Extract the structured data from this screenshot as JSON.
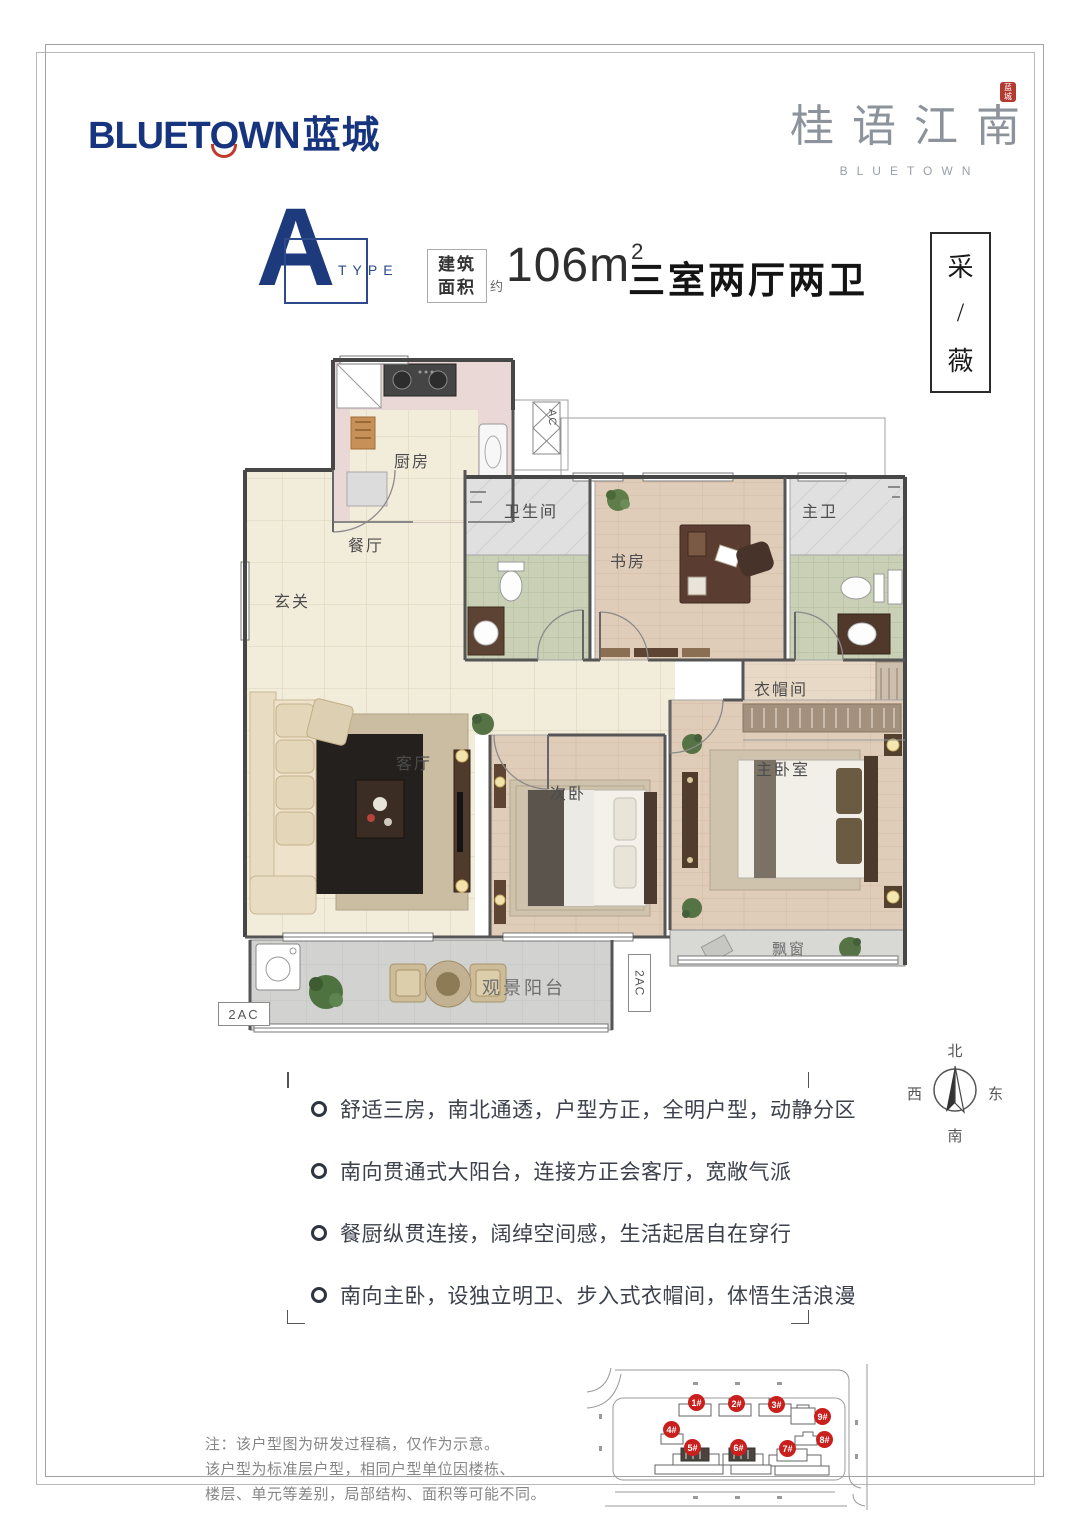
{
  "brand": {
    "bluetown": {
      "p1": "BLUET",
      "o": "O",
      "p2": "WN",
      "cn": "蓝城"
    },
    "project": {
      "chars": [
        "桂",
        "语",
        "江",
        "南"
      ],
      "seal": "蓝城",
      "subtitle": "BLUETOWN"
    }
  },
  "header": {
    "type_letter": "A",
    "type_word": "TYPE",
    "area_box": {
      "l1": "建筑",
      "l2": "面积"
    },
    "approx": "约",
    "area_value": "106m",
    "area_sup": "2",
    "layout": "三室两厅两卫"
  },
  "side_label": {
    "chars": [
      "采",
      "/",
      "薇"
    ]
  },
  "plan": {
    "rooms": {
      "kitchen": "厨房",
      "dining": "餐厅",
      "entry": "玄关",
      "bath": "卫生间",
      "study": "书房",
      "master_bath": "主卫",
      "closet": "衣帽间",
      "living": "客厅",
      "second_bed": "次卧",
      "master_bed": "主卧室",
      "bay": "飘窗",
      "balcony": "观景阳台"
    },
    "ac_top": "AC",
    "ac_left": "2AC",
    "ac_right": "2AC"
  },
  "compass": {
    "n": "北",
    "e": "东",
    "s": "南",
    "w": "西"
  },
  "features": [
    "舒适三房，南北通透，户型方正，全明户型，动静分区",
    "南向贯通式大阳台，连接方正会客厅，宽敞气派",
    "餐厨纵贯连接，阔绰空间感，生活起居自在穿行",
    "南向主卧，设独立明卫、步入式衣帽间，体悟生活浪漫"
  ],
  "note": [
    "注：该户型图为研发过程稿，仅作为示意。",
    "该户型为标准层户型，相同户型单位因楼栋、",
    "楼层、单元等差别，局部结构、面积等可能不同。"
  ],
  "siteplan": {
    "buildings": [
      "1#",
      "2#",
      "3#",
      "9#",
      "4#",
      "8#",
      "5#",
      "6#",
      "7#"
    ]
  }
}
